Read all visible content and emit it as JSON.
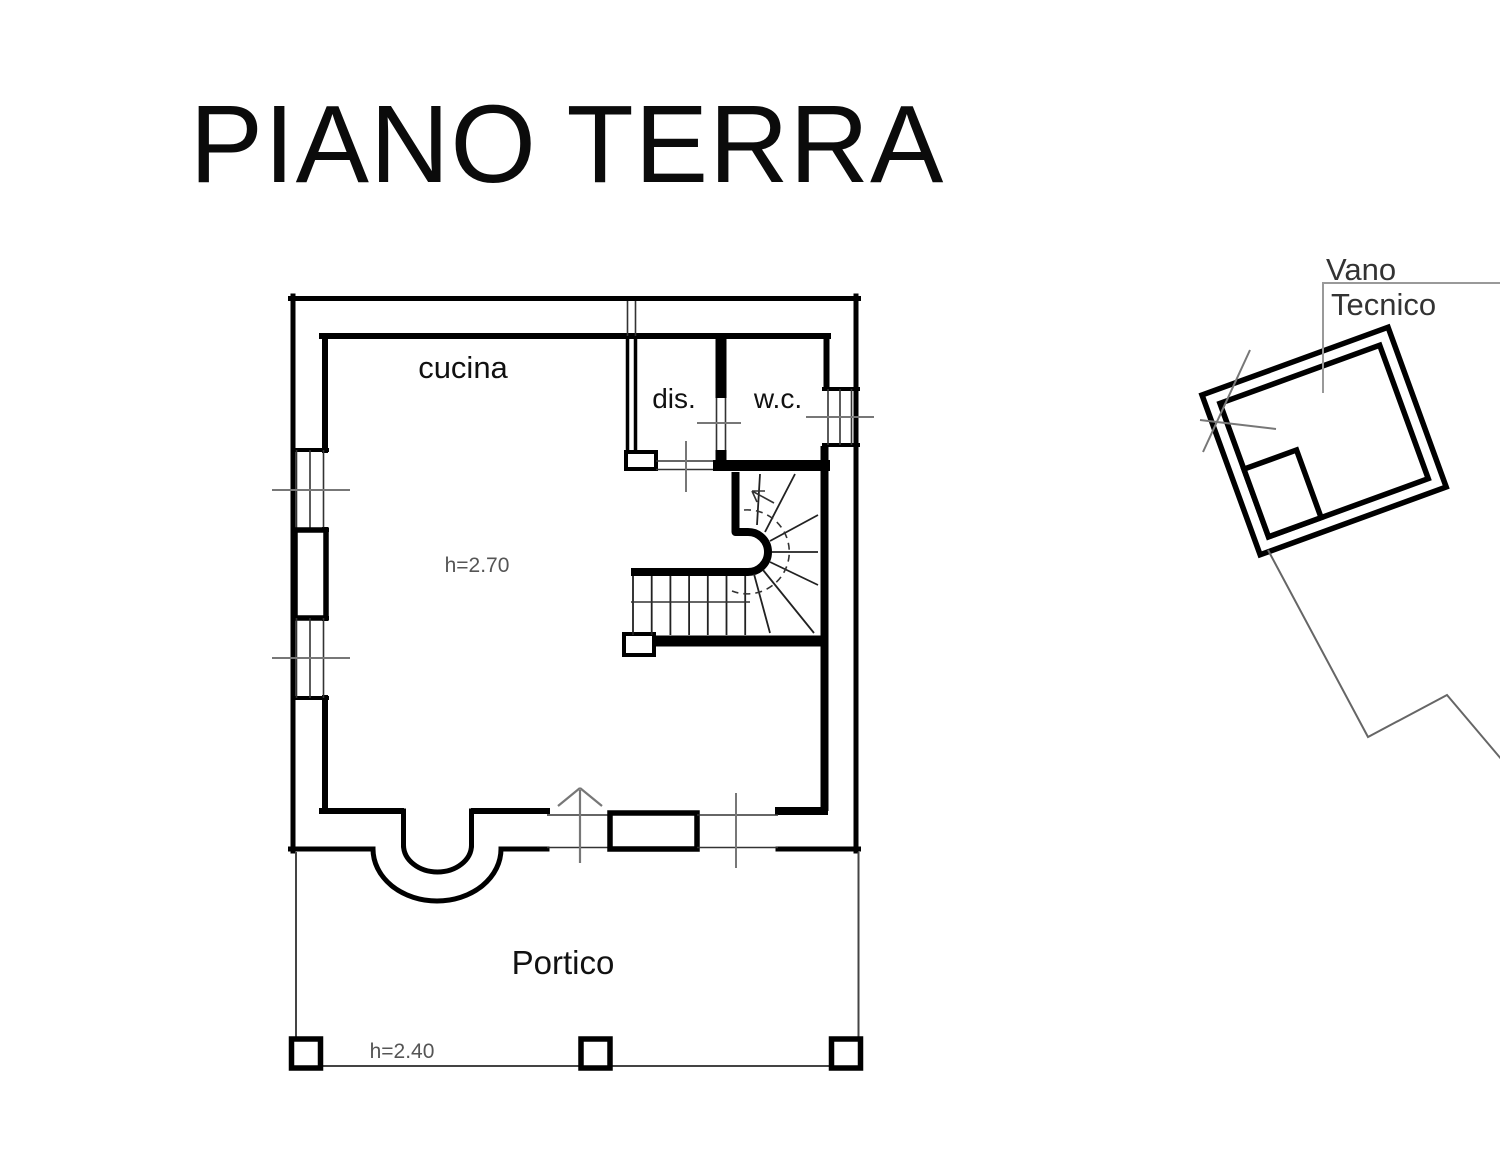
{
  "title": "PIANO TERRA",
  "floor_plan": {
    "rooms": {
      "kitchen": "cucina",
      "hallway": "dis.",
      "wc": "w.c.",
      "porch": "Portico"
    },
    "annotations": {
      "interior_height": "h=2.70",
      "porch_height": "h=2.40"
    },
    "outbuilding": {
      "label_line1": "Vano",
      "label_line2": "Tecnico"
    }
  },
  "colors": {
    "background": "#ffffff",
    "wall_line": "#000000",
    "thin_line": "#333333",
    "centerline": "#777777",
    "leader_line": "#999999",
    "annotation_text": "#555555",
    "label_text": "#111111"
  }
}
